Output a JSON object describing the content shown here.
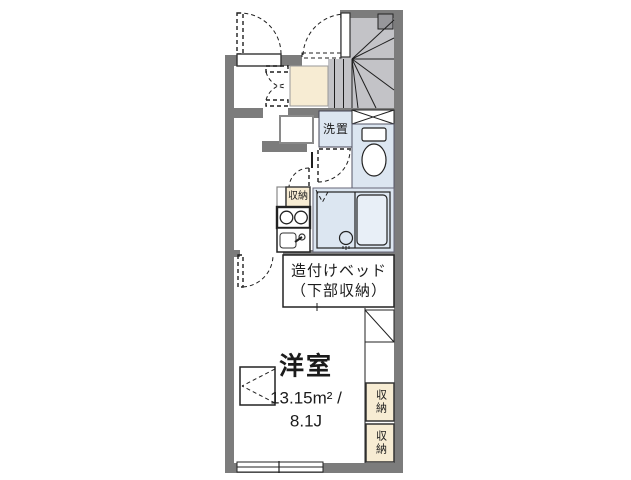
{
  "floorplan": {
    "rooms": {
      "laundry_label": "洗置",
      "kitchen_storage_label": "収納",
      "bed_label_line1": "造付けベッド",
      "bed_label_line2": "（下部収納）",
      "room_label": "洋室",
      "room_area_sqm": "13.15m² /",
      "room_area_tatami": "8.1J",
      "closet_top_label": "収納",
      "closet_bottom_label": "収納"
    },
    "colors": {
      "wall": "#7c7c7c",
      "stairs_fill": "#c3c3c7",
      "stairs_dark_square": "#97979b",
      "water_area": "#dce6f1",
      "tub_fill": "#e8eff7",
      "storage_beige": "#f7ecd3",
      "line": "#1f1f1f",
      "text": "#1b1b1b"
    }
  }
}
